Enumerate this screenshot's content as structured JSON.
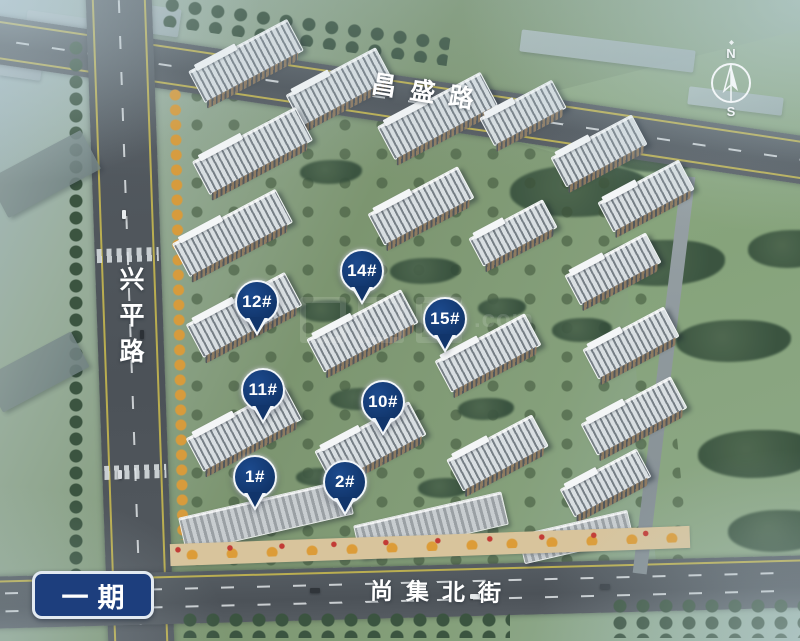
{
  "roads": {
    "top_label": "昌盛路",
    "left_label": "兴平路",
    "bottom_label": "尚集北街"
  },
  "phase_badge": {
    "label": "一期"
  },
  "compass": {
    "north": "N",
    "south": "S"
  },
  "markers": [
    {
      "id": "12",
      "label": "12#"
    },
    {
      "id": "14",
      "label": "14#"
    },
    {
      "id": "15",
      "label": "15#"
    },
    {
      "id": "11",
      "label": "11#"
    },
    {
      "id": "10",
      "label": "10#"
    },
    {
      "id": "1",
      "label": "1#"
    },
    {
      "id": "2",
      "label": "2#"
    }
  ],
  "watermark": {
    "text": ".com"
  },
  "colors": {
    "pin_fill": "#11356b",
    "pin_border": "#f2f6fa",
    "badge_bg": "#1d3e7d",
    "badge_border": "#e3eaf1",
    "label_text": "#ffffff"
  }
}
